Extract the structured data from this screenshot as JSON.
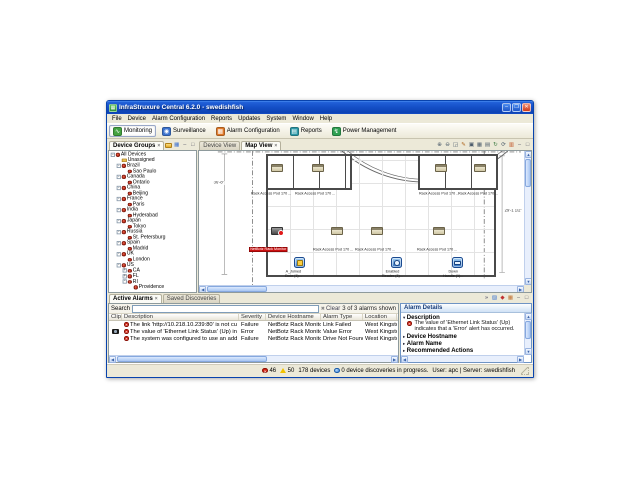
{
  "window": {
    "title": "InfraStruxure Central 6.2.0 - swedishfish",
    "controls": {
      "minimize": "–",
      "maximize": "❐",
      "close": "✕"
    }
  },
  "menu": {
    "items": [
      "File",
      "Device",
      "Alarm Configuration",
      "Reports",
      "Updates",
      "System",
      "Window",
      "Help"
    ]
  },
  "app_toolbar": {
    "buttons": [
      {
        "label": "Monitoring",
        "icon": "monitoring-icon",
        "glyph": "∿",
        "color": "#44a340",
        "active": true
      },
      {
        "label": "Surveillance",
        "icon": "surveillance-icon",
        "glyph": "◉",
        "color": "#3e74cf",
        "active": false
      },
      {
        "label": "Alarm Configuration",
        "icon": "alarm-configuration-icon",
        "glyph": "▦",
        "color": "#e07a2a",
        "active": false
      },
      {
        "label": "Reports",
        "icon": "reports-icon",
        "glyph": "▤",
        "color": "#2e9aa8",
        "active": false
      },
      {
        "label": "Power Management",
        "icon": "power-management-icon",
        "glyph": "↯",
        "color": "#2fa052",
        "active": false
      }
    ]
  },
  "sidebar": {
    "tab": "Device Groups",
    "tree": [
      {
        "label": "All Devices",
        "level": 0,
        "expander": "minus",
        "icon": "group"
      },
      {
        "label": "Unassigned",
        "level": 1,
        "expander": "none",
        "icon": "folder"
      },
      {
        "label": "Brazil",
        "level": 1,
        "expander": "minus",
        "icon": "group"
      },
      {
        "label": "Sao Paulo",
        "level": 2,
        "expander": "none",
        "icon": "group"
      },
      {
        "label": "Canada",
        "level": 1,
        "expander": "minus",
        "icon": "group"
      },
      {
        "label": "Ontario",
        "level": 2,
        "expander": "none",
        "icon": "group"
      },
      {
        "label": "China",
        "level": 1,
        "expander": "minus",
        "icon": "group"
      },
      {
        "label": "Beijing",
        "level": 2,
        "expander": "none",
        "icon": "group"
      },
      {
        "label": "France",
        "level": 1,
        "expander": "minus",
        "icon": "group"
      },
      {
        "label": "Paris",
        "level": 2,
        "expander": "none",
        "icon": "group"
      },
      {
        "label": "India",
        "level": 1,
        "expander": "minus",
        "icon": "group"
      },
      {
        "label": "Hyderabad",
        "level": 2,
        "expander": "none",
        "icon": "group"
      },
      {
        "label": "Japan",
        "level": 1,
        "expander": "minus",
        "icon": "group"
      },
      {
        "label": "Tokyo",
        "level": 2,
        "expander": "none",
        "icon": "group"
      },
      {
        "label": "Russia",
        "level": 1,
        "expander": "minus",
        "icon": "group"
      },
      {
        "label": "St. Petersburg",
        "level": 2,
        "expander": "none",
        "icon": "group"
      },
      {
        "label": "Spain",
        "level": 1,
        "expander": "minus",
        "icon": "group"
      },
      {
        "label": "Madrid",
        "level": 2,
        "expander": "none",
        "icon": "group"
      },
      {
        "label": "UK",
        "level": 1,
        "expander": "minus",
        "icon": "group"
      },
      {
        "label": "London",
        "level": 2,
        "expander": "none",
        "icon": "group"
      },
      {
        "label": "US",
        "level": 1,
        "expander": "minus",
        "icon": "group"
      },
      {
        "label": "CA",
        "level": 2,
        "expander": "plus",
        "icon": "group"
      },
      {
        "label": "FL",
        "level": 2,
        "expander": "plus",
        "icon": "group"
      },
      {
        "label": "RI",
        "level": 2,
        "expander": "minus",
        "icon": "group"
      },
      {
        "label": "Providence",
        "level": 3,
        "expander": "none",
        "icon": "group"
      }
    ]
  },
  "map": {
    "tabs": [
      {
        "label": "Device View",
        "active": false
      },
      {
        "label": "Map View",
        "active": true
      }
    ],
    "toolbar_icons": [
      {
        "name": "zoom-in-icon",
        "glyph": "⊕",
        "color": "#4a5a6a"
      },
      {
        "name": "zoom-out-icon",
        "glyph": "⊖",
        "color": "#4a5a6a"
      },
      {
        "name": "zoom-selection-icon",
        "glyph": "◲",
        "color": "#4a5a6a"
      },
      {
        "name": "edit-map-icon",
        "glyph": "✎",
        "color": "#b06820"
      },
      {
        "name": "copy-map-icon",
        "glyph": "▣",
        "color": "#4a5a6a"
      },
      {
        "name": "grid-view-icon",
        "glyph": "▦",
        "color": "#4a5a6a"
      },
      {
        "name": "layers-icon",
        "glyph": "▤",
        "color": "#4a5a6a"
      },
      {
        "name": "rotate-map-icon",
        "glyph": "↻",
        "color": "#3a7a40"
      },
      {
        "name": "refresh-map-icon",
        "glyph": "⟳",
        "color": "#4a5a6a"
      },
      {
        "name": "building-view-icon",
        "glyph": "▥",
        "color": "#c05020"
      }
    ],
    "dimension_left": "36'-8\"",
    "dimension_right": "29'-1 1/2\"",
    "rack_label": "Rack Access Pod 170 ...",
    "alert_label": {
      "x": 50,
      "y": 96,
      "text": "NetBotz Rack Monitor"
    },
    "devices": [
      {
        "type": "rack",
        "x": 72,
        "y": 13
      },
      {
        "type": "rack",
        "x": 113,
        "y": 13
      },
      {
        "type": "rack",
        "x": 236,
        "y": 13
      },
      {
        "type": "rack",
        "x": 275,
        "y": 13
      },
      {
        "type": "camera",
        "x": 72,
        "y": 76
      },
      {
        "type": "rack",
        "x": 132,
        "y": 76
      },
      {
        "type": "rack",
        "x": 172,
        "y": 76
      },
      {
        "type": "rack",
        "x": 234,
        "y": 76
      },
      {
        "type": "door",
        "x": 95,
        "y": 106
      },
      {
        "type": "reader",
        "x": 192,
        "y": 106
      },
      {
        "type": "handle",
        "x": 253,
        "y": 106
      }
    ],
    "rack_labels": [
      {
        "x": 52,
        "y": 41
      },
      {
        "x": 96,
        "y": 41
      },
      {
        "x": 220,
        "y": 41
      },
      {
        "x": 259,
        "y": 41
      },
      {
        "x": 114,
        "y": 97
      },
      {
        "x": 156,
        "y": 97
      },
      {
        "x": 218,
        "y": 97
      }
    ],
    "door_labels": [
      {
        "x": 86,
        "y": 119,
        "lines": [
          "A_Joined",
          "Door (1)..."
        ]
      },
      {
        "x": 183,
        "y": 119,
        "lines": [
          "Enabled",
          "Reader (1)..."
        ]
      },
      {
        "x": 244,
        "y": 119,
        "lines": [
          "Down",
          "Handle (1)..."
        ]
      }
    ]
  },
  "alarms": {
    "tabs": [
      {
        "label": "Active Alarms",
        "active": true
      },
      {
        "label": "Saved Discoveries",
        "active": false
      }
    ],
    "search_label": "Search",
    "search_value": "",
    "clear_label": "Clear",
    "count_text": "3 of 3 alarms shown",
    "columns": [
      "Clip",
      "Description",
      "Severity",
      "Device Hostname",
      "Alarm Type",
      "Location"
    ],
    "rows": [
      {
        "clip": false,
        "description": "The link 'http://10.218.10.239:80' is not currently functioning corre...",
        "severity": "Failure",
        "hostname": "NetBotz Rack Monitor 550",
        "type": "Link Failed",
        "location": "West Kingston"
      },
      {
        "clip": true,
        "description": "The value of 'Ethernet Link Status' (Up) indicates that a 'Error' alert ...",
        "severity": "Error",
        "hostname": "NetBotz Rack Monitor 550",
        "type": "Value Error",
        "location": "West Kingston"
      },
      {
        "clip": false,
        "description": "The system was configured to use an add-on or network drive for s...",
        "severity": "Failure",
        "hostname": "NetBotz Rack Monitor 550",
        "type": "Drive Not Found",
        "location": "West Kingston"
      }
    ]
  },
  "details": {
    "title": "Alarm Details",
    "toolbar_icons": [
      {
        "name": "show-more-icon",
        "glyph": "»",
        "color": "#335"
      },
      {
        "name": "pin-panel-icon",
        "glyph": "▨",
        "color": "#3e74cf"
      },
      {
        "name": "alarm-badge-icon",
        "glyph": "◆",
        "color": "#c03030"
      },
      {
        "name": "building-icon",
        "glyph": "▦",
        "color": "#c07030"
      }
    ],
    "sections": [
      {
        "label": "Description",
        "expanded": true,
        "text": "The value of 'Ethernet Link Status' (Up) indicates that a 'Error' alert has occurred."
      },
      {
        "label": "Device Hostname",
        "expanded": false
      },
      {
        "label": "Alarm Name",
        "expanded": false
      },
      {
        "label": "Recommended Actions",
        "expanded": false
      }
    ]
  },
  "statusbar": {
    "critical_count": "46",
    "warning_count": "50",
    "device_count": "178 devices",
    "discovery_text": "0 device discoveries in progress.",
    "session_text": "User: apc | Server: swedishfish"
  }
}
